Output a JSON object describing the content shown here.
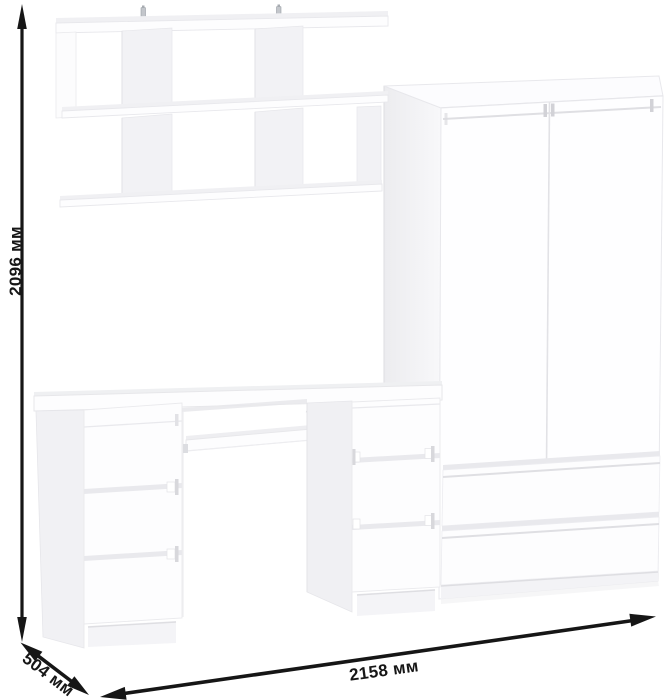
{
  "scene": {
    "description": "White furniture set with dimension arrows",
    "background_color": "#ffffff",
    "furniture_color": "#ffffff",
    "objects": [
      "wall-shelf",
      "wardrobe-with-two-doors-and-two-drawers",
      "computer-desk-with-six-drawers-and-keyboard-tray"
    ],
    "arrow_color": "#161616"
  },
  "dimensions": {
    "height_label": "2096 мм",
    "depth_label": "504 мм",
    "width_label": "2158 мм",
    "text_color": "#161616"
  }
}
